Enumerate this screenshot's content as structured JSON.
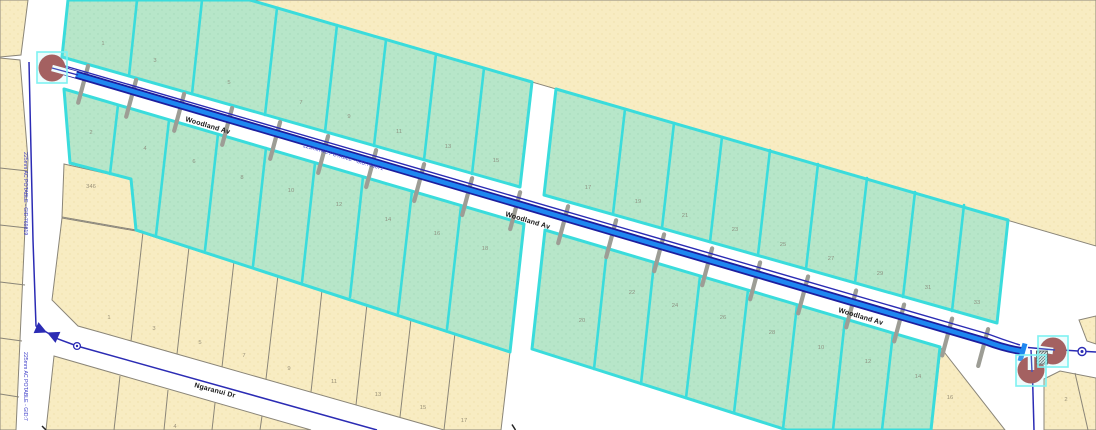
{
  "canvas": {
    "width": 1096,
    "height": 430
  },
  "colors": {
    "background": "#ffffff",
    "parcel_tan": "#f8ecc2",
    "parcel_tan_border": "#8a8578",
    "parcel_green": "#b7e6c9",
    "parcel_green_border": "#3adcdc",
    "water_main_blue": "#1e87f0",
    "water_main_casing": "#1d1d9e",
    "water_line_navy": "#2b2bb4",
    "service_lateral_gray": "#9d9d95",
    "selected_symbol_red": "#a54343",
    "selection_box_cyan": "#7ef2f2",
    "parcel_number_text": "#8f9383",
    "street_label_text": "#161616",
    "pipe_label_text": "#3b3bc8"
  },
  "street_labels": [
    {
      "text": "Woodland Av",
      "x": 185,
      "y": 121,
      "rot": 16.5
    },
    {
      "text": "Woodland Av",
      "x": 505,
      "y": 216,
      "rot": 16.5
    },
    {
      "text": "Woodland Av",
      "x": 838,
      "y": 312,
      "rot": 16.5
    },
    {
      "text": "Ngaranui Dr",
      "x": 194,
      "y": 387,
      "rot": 15
    }
  ],
  "pipe_labels": [
    {
      "text": "225mm AC POTABLE - GID:769819",
      "x": 24,
      "y": 152,
      "rot": 90
    },
    {
      "text": "225mm AC POTABLE - GID:7",
      "x": 24,
      "y": 352,
      "rot": 90
    },
    {
      "text": "225mm AC POTABLE - GID:766071",
      "x": 303,
      "y": 147,
      "rot": 16.3
    }
  ],
  "parcel_numbers": {
    "green": [
      {
        "n": "1",
        "x": 103,
        "y": 45
      },
      {
        "n": "3",
        "x": 155,
        "y": 62
      },
      {
        "n": "5",
        "x": 229,
        "y": 84
      },
      {
        "n": "7",
        "x": 301,
        "y": 104
      },
      {
        "n": "9",
        "x": 349,
        "y": 118
      },
      {
        "n": "11",
        "x": 399,
        "y": 133
      },
      {
        "n": "13",
        "x": 448,
        "y": 148
      },
      {
        "n": "15",
        "x": 496,
        "y": 162
      },
      {
        "n": "2",
        "x": 91,
        "y": 134
      },
      {
        "n": "4",
        "x": 145,
        "y": 150
      },
      {
        "n": "6",
        "x": 194,
        "y": 163
      },
      {
        "n": "8",
        "x": 242,
        "y": 179
      },
      {
        "n": "10",
        "x": 291,
        "y": 192
      },
      {
        "n": "12",
        "x": 339,
        "y": 206
      },
      {
        "n": "14",
        "x": 388,
        "y": 221
      },
      {
        "n": "16",
        "x": 437,
        "y": 235
      },
      {
        "n": "18",
        "x": 485,
        "y": 250
      },
      {
        "n": "17",
        "x": 588,
        "y": 189
      },
      {
        "n": "19",
        "x": 638,
        "y": 203
      },
      {
        "n": "21",
        "x": 685,
        "y": 217
      },
      {
        "n": "23",
        "x": 735,
        "y": 231
      },
      {
        "n": "25",
        "x": 783,
        "y": 246
      },
      {
        "n": "27",
        "x": 831,
        "y": 260
      },
      {
        "n": "29",
        "x": 880,
        "y": 275
      },
      {
        "n": "31",
        "x": 928,
        "y": 289
      },
      {
        "n": "33",
        "x": 977,
        "y": 304
      },
      {
        "n": "20",
        "x": 582,
        "y": 322
      },
      {
        "n": "22",
        "x": 632,
        "y": 294
      },
      {
        "n": "24",
        "x": 675,
        "y": 307
      },
      {
        "n": "26",
        "x": 723,
        "y": 319
      },
      {
        "n": "28",
        "x": 772,
        "y": 334
      },
      {
        "n": "10",
        "x": 821,
        "y": 349
      },
      {
        "n": "12",
        "x": 868,
        "y": 363
      },
      {
        "n": "14",
        "x": 918,
        "y": 378
      }
    ],
    "tan": [
      {
        "n": "346",
        "x": 91,
        "y": 188
      },
      {
        "n": "1",
        "x": 109,
        "y": 319
      },
      {
        "n": "3",
        "x": 154,
        "y": 330
      },
      {
        "n": "5",
        "x": 200,
        "y": 344
      },
      {
        "n": "7",
        "x": 244,
        "y": 357
      },
      {
        "n": "9",
        "x": 289,
        "y": 370
      },
      {
        "n": "11",
        "x": 334,
        "y": 383
      },
      {
        "n": "13",
        "x": 378,
        "y": 396
      },
      {
        "n": "15",
        "x": 423,
        "y": 409
      },
      {
        "n": "17",
        "x": 464,
        "y": 422
      },
      {
        "n": "4",
        "x": 175,
        "y": 428
      },
      {
        "n": "16",
        "x": 950,
        "y": 399
      },
      {
        "n": "2",
        "x": 1066,
        "y": 401
      }
    ]
  },
  "symbols": [
    {
      "name": "hydrant-selected-left",
      "x": 52,
      "y": 68
    },
    {
      "name": "hydrant-selected-lower",
      "x": 1031,
      "y": 370
    },
    {
      "name": "hydrant-selected-upper",
      "x": 1053,
      "y": 351
    },
    {
      "name": "gate-valve",
      "x": 47,
      "y": 332
    },
    {
      "name": "pipe-fitting",
      "x": 77,
      "y": 346
    },
    {
      "name": "pipe-fitting-cross",
      "x": 1082,
      "y": 351
    }
  ]
}
